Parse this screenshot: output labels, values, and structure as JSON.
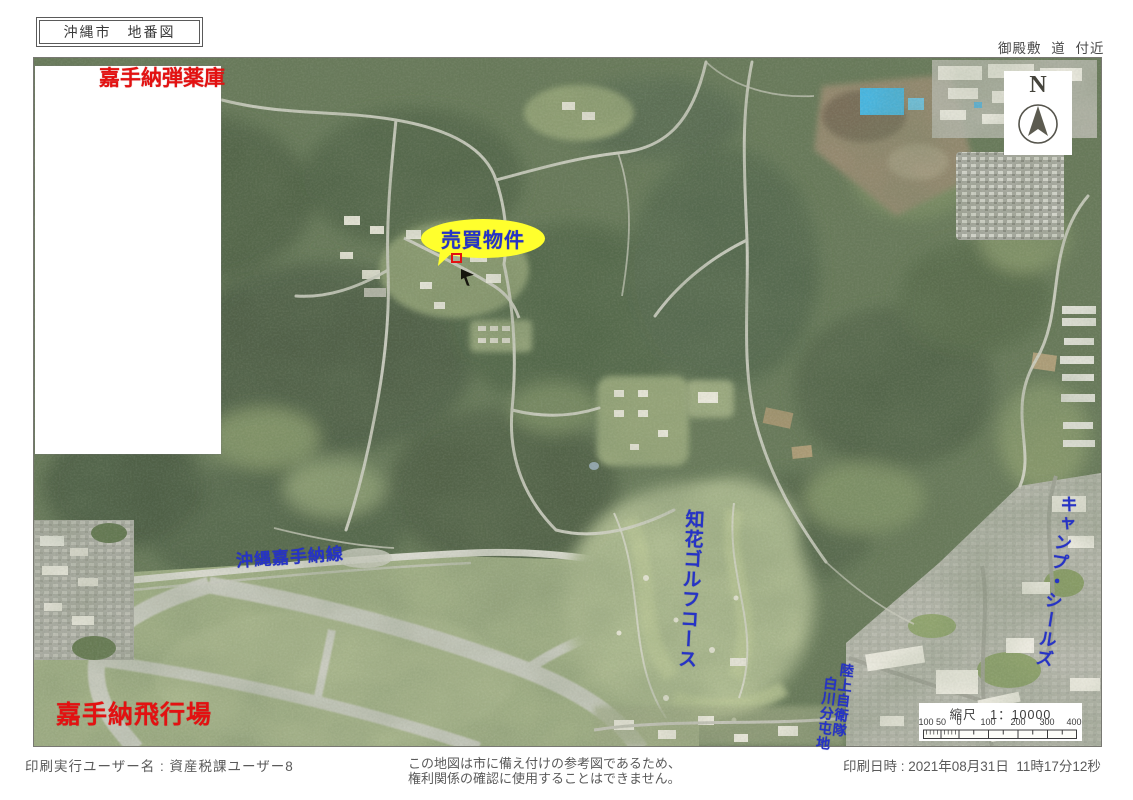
{
  "header": {
    "title": "沖縄市　地番図",
    "area_note": "御殿敷 道 付近"
  },
  "map": {
    "labels": {
      "ammo_depot": "嘉手納弾薬庫",
      "property": "売買物件",
      "kadena_line": "沖縄嘉手納線",
      "golf_course": "知花ゴルフコース",
      "camp_shields": "キャンプ・シールズ",
      "jgsdf_unit": "陸上自衛隊",
      "shirakawa_base": "白川分屯地",
      "airfield": "嘉手納飛行場"
    },
    "north_label": "N",
    "scale": {
      "title": "縮尺　1：10000",
      "ticks": [
        "100",
        "50",
        "0",
        "100",
        "200",
        "300",
        "400"
      ]
    },
    "colors": {
      "label_red": "#e31111",
      "label_blue": "#2633c6",
      "bubble_yellow": "#ffff2d"
    }
  },
  "footer": {
    "printed_by": "印刷実行ユーザー名 : 資産税課ユーザー8",
    "disclaimer_line1": "この地図は市に備え付けの参考図であるため、",
    "disclaimer_line2": "権利関係の確認に使用することはできません。",
    "printed_at": "印刷日時 : 2021年08月31日  11時17分12秒"
  }
}
